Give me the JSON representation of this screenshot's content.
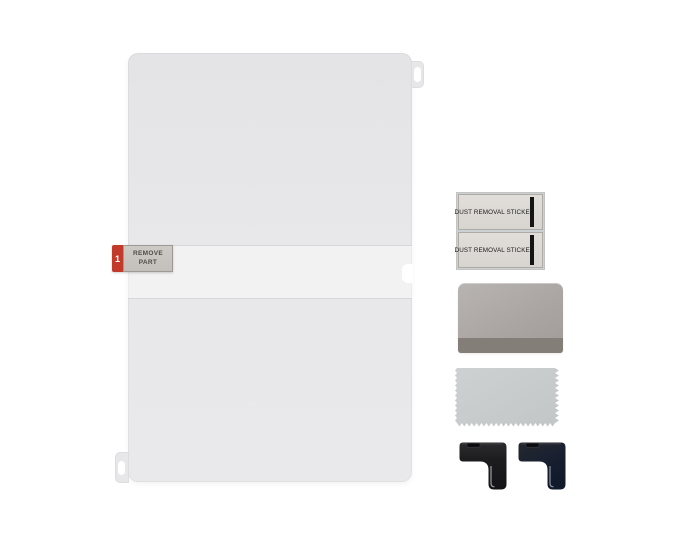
{
  "scene": {
    "background_color": "#ffffff"
  },
  "film": {
    "color": "#e8e8ea",
    "seam_color": "#d7d7d9",
    "sticker": {
      "step_number": "1",
      "label": "REMOVE PART",
      "badge_color": "#c13a2a",
      "label_bg": "#c8c5c0",
      "label_text_color": "#4f4c47"
    }
  },
  "dust_stickers": {
    "items": [
      {
        "label": "DUST REMOVAL STICKER"
      },
      {
        "label": "DUST REMOVAL STICKER"
      }
    ],
    "base_color": "#dedbd6",
    "bar_color": "#141414"
  },
  "squeegee": {
    "body_color": "#aba6a4",
    "edge_color": "#847e79"
  },
  "cloth": {
    "color": "#c7cbcb"
  },
  "corner_guides": {
    "count": 2,
    "body_color": "#1d1d20",
    "blue_tint_color": "#101a2b",
    "stripe_color": "#aeaeb2"
  }
}
